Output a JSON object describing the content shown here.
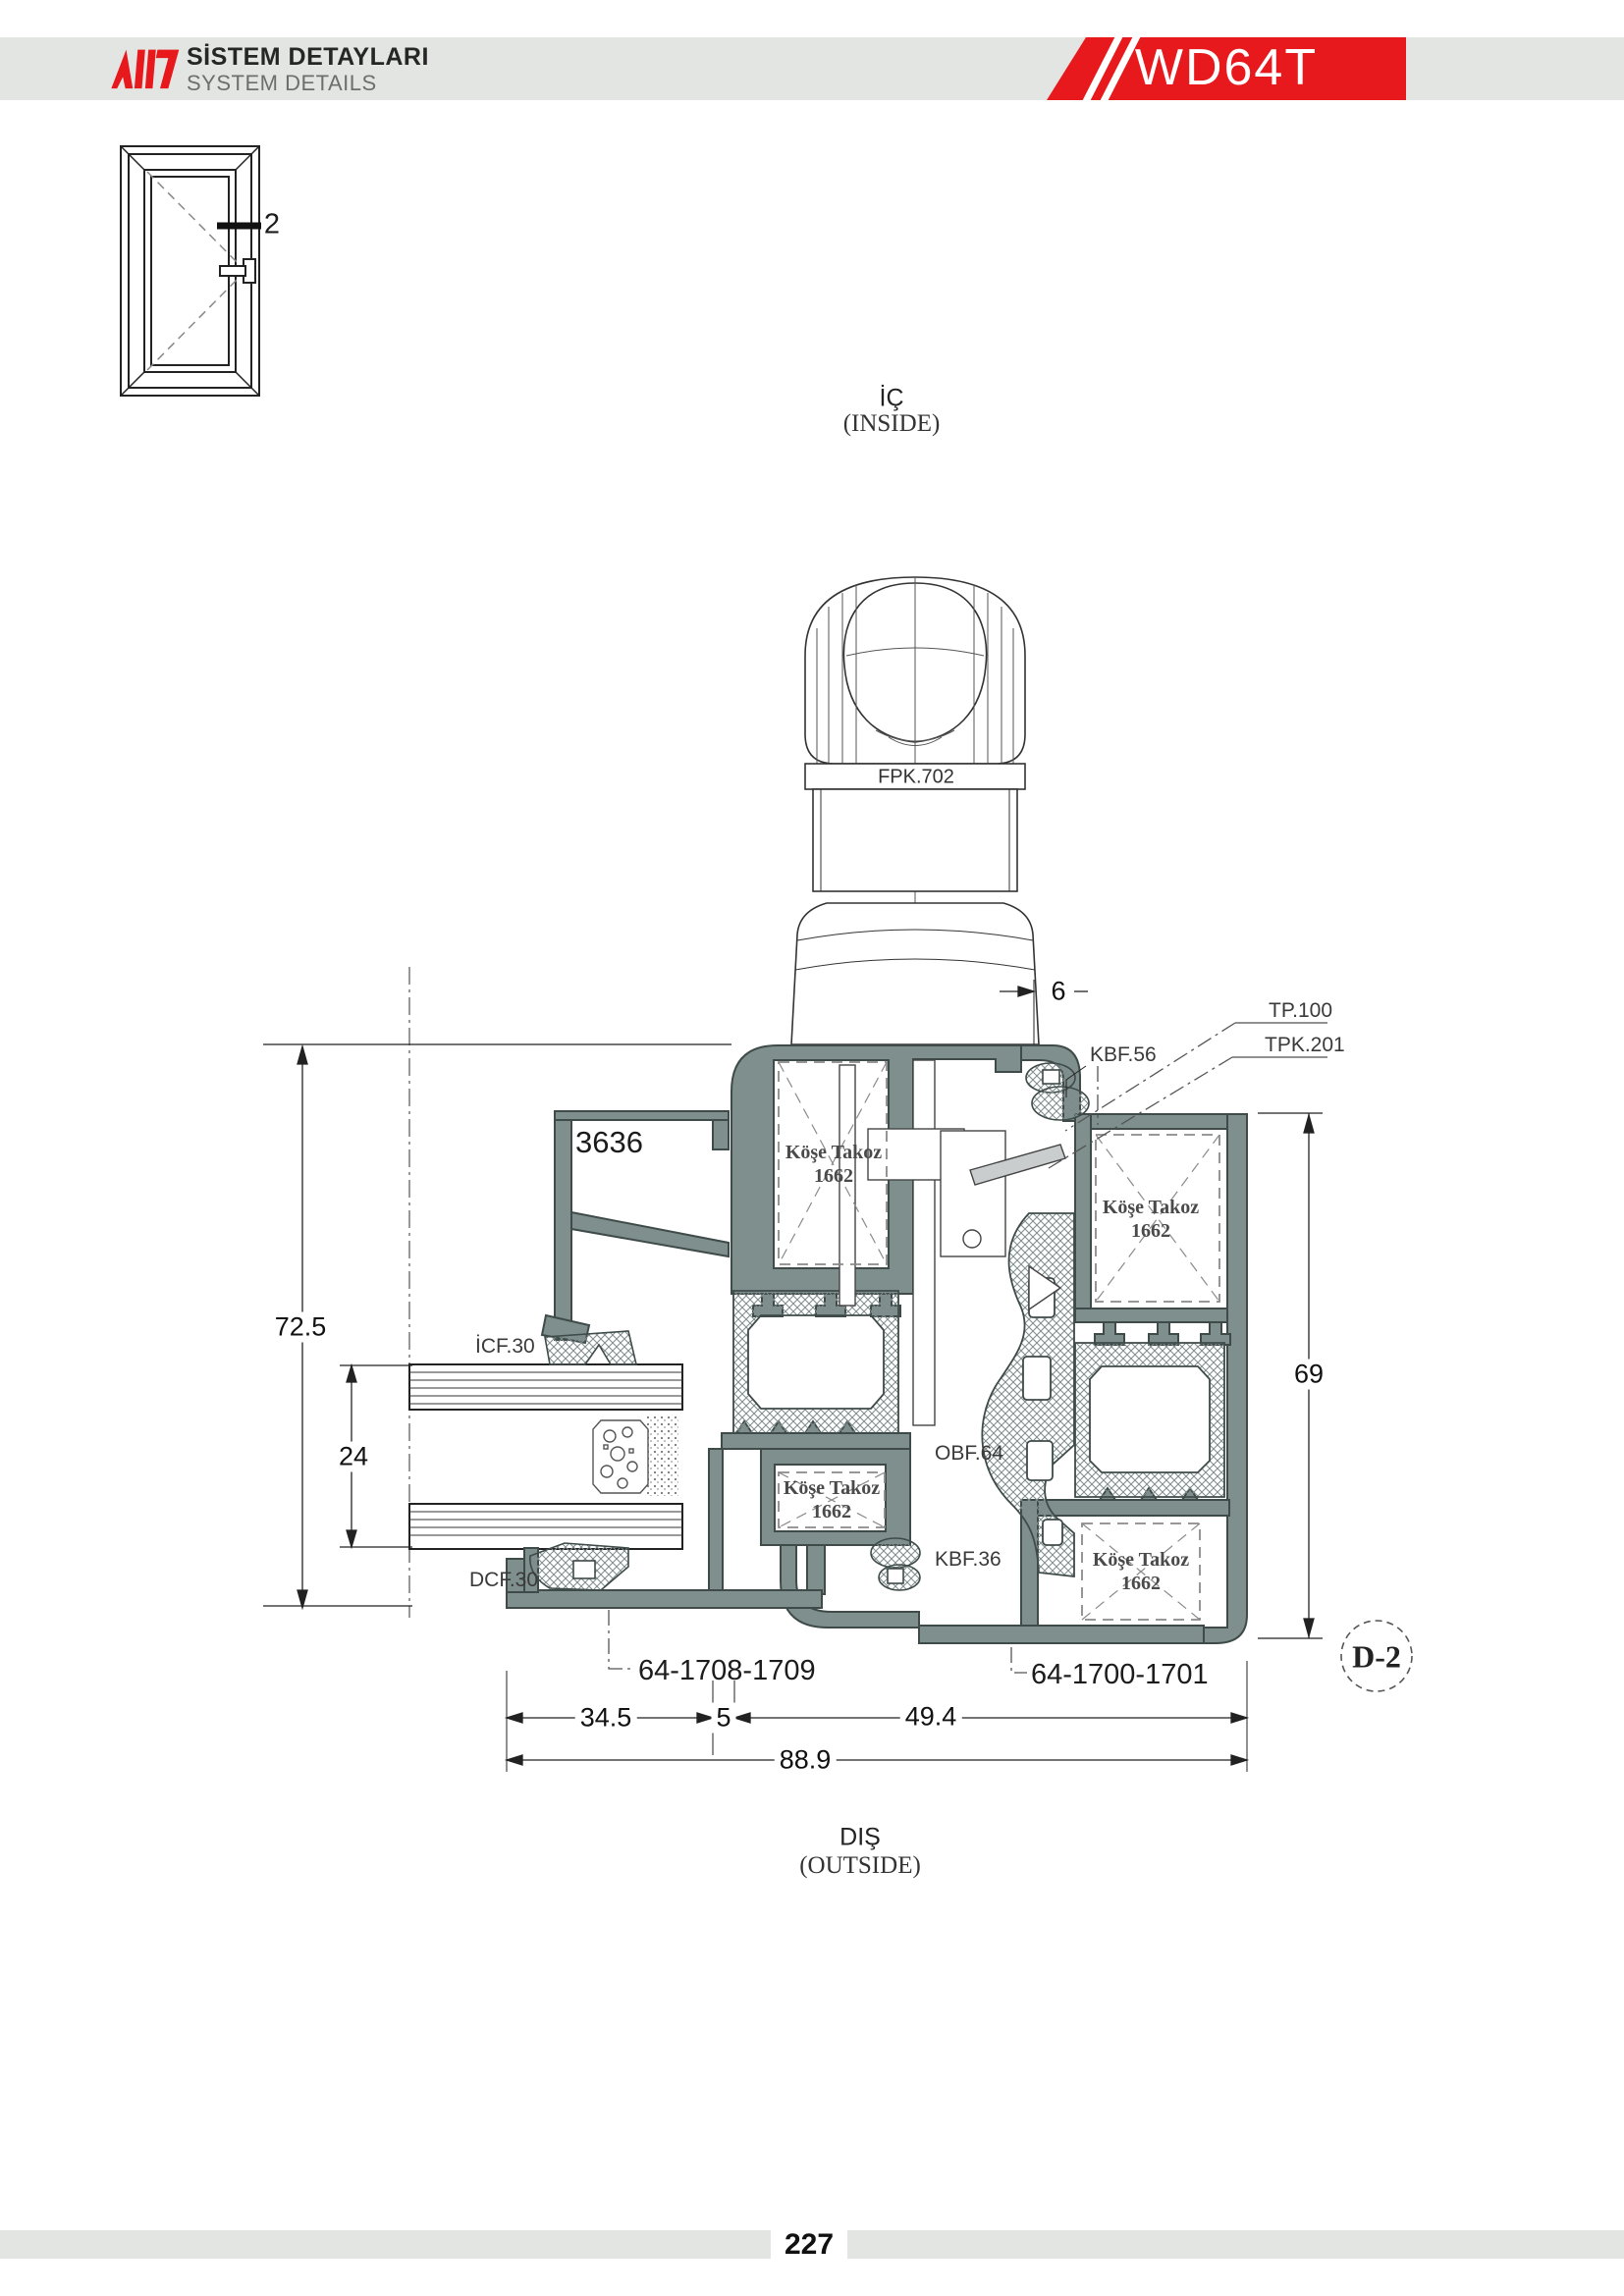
{
  "header": {
    "title": "SİSTEM DETAYLARI",
    "subtitle": "SYSTEM DETAILS",
    "system_code": "WD64T"
  },
  "window_icon": {
    "section_marker": "2"
  },
  "orientation": {
    "inside_tr": "İÇ",
    "inside_en": "(INSIDE)",
    "outside_tr": "DIŞ",
    "outside_en": "(OUTSIDE)"
  },
  "labels": {
    "handle": "FPK.702",
    "glazing_bead": "3636",
    "kbf56": "KBF.56",
    "tp100": "TP.100",
    "tpk201": "TPK.201",
    "icf30": "İCF.30",
    "dcf30": "DCF.30",
    "obf64": "OBF.64",
    "kbf36": "KBF.36",
    "sash_part": "64-1708-1709",
    "frame_part": "64-1700-1701",
    "detail_ref": "D-2",
    "corner_block_line1": "Köşe Takoz",
    "corner_block_line2": "1662"
  },
  "dimensions": {
    "handle_offset": "6",
    "overall_height": "72.5",
    "glass_thickness": "24",
    "frame_height": "69",
    "sash_width": "34.5",
    "gap": "5",
    "frame_width": "49.4",
    "total_width": "88.9"
  },
  "page": {
    "number": "227"
  },
  "colors": {
    "accent": "#E8191D",
    "aluminum": "#7E8F8D",
    "band": "#E3E5E3"
  }
}
